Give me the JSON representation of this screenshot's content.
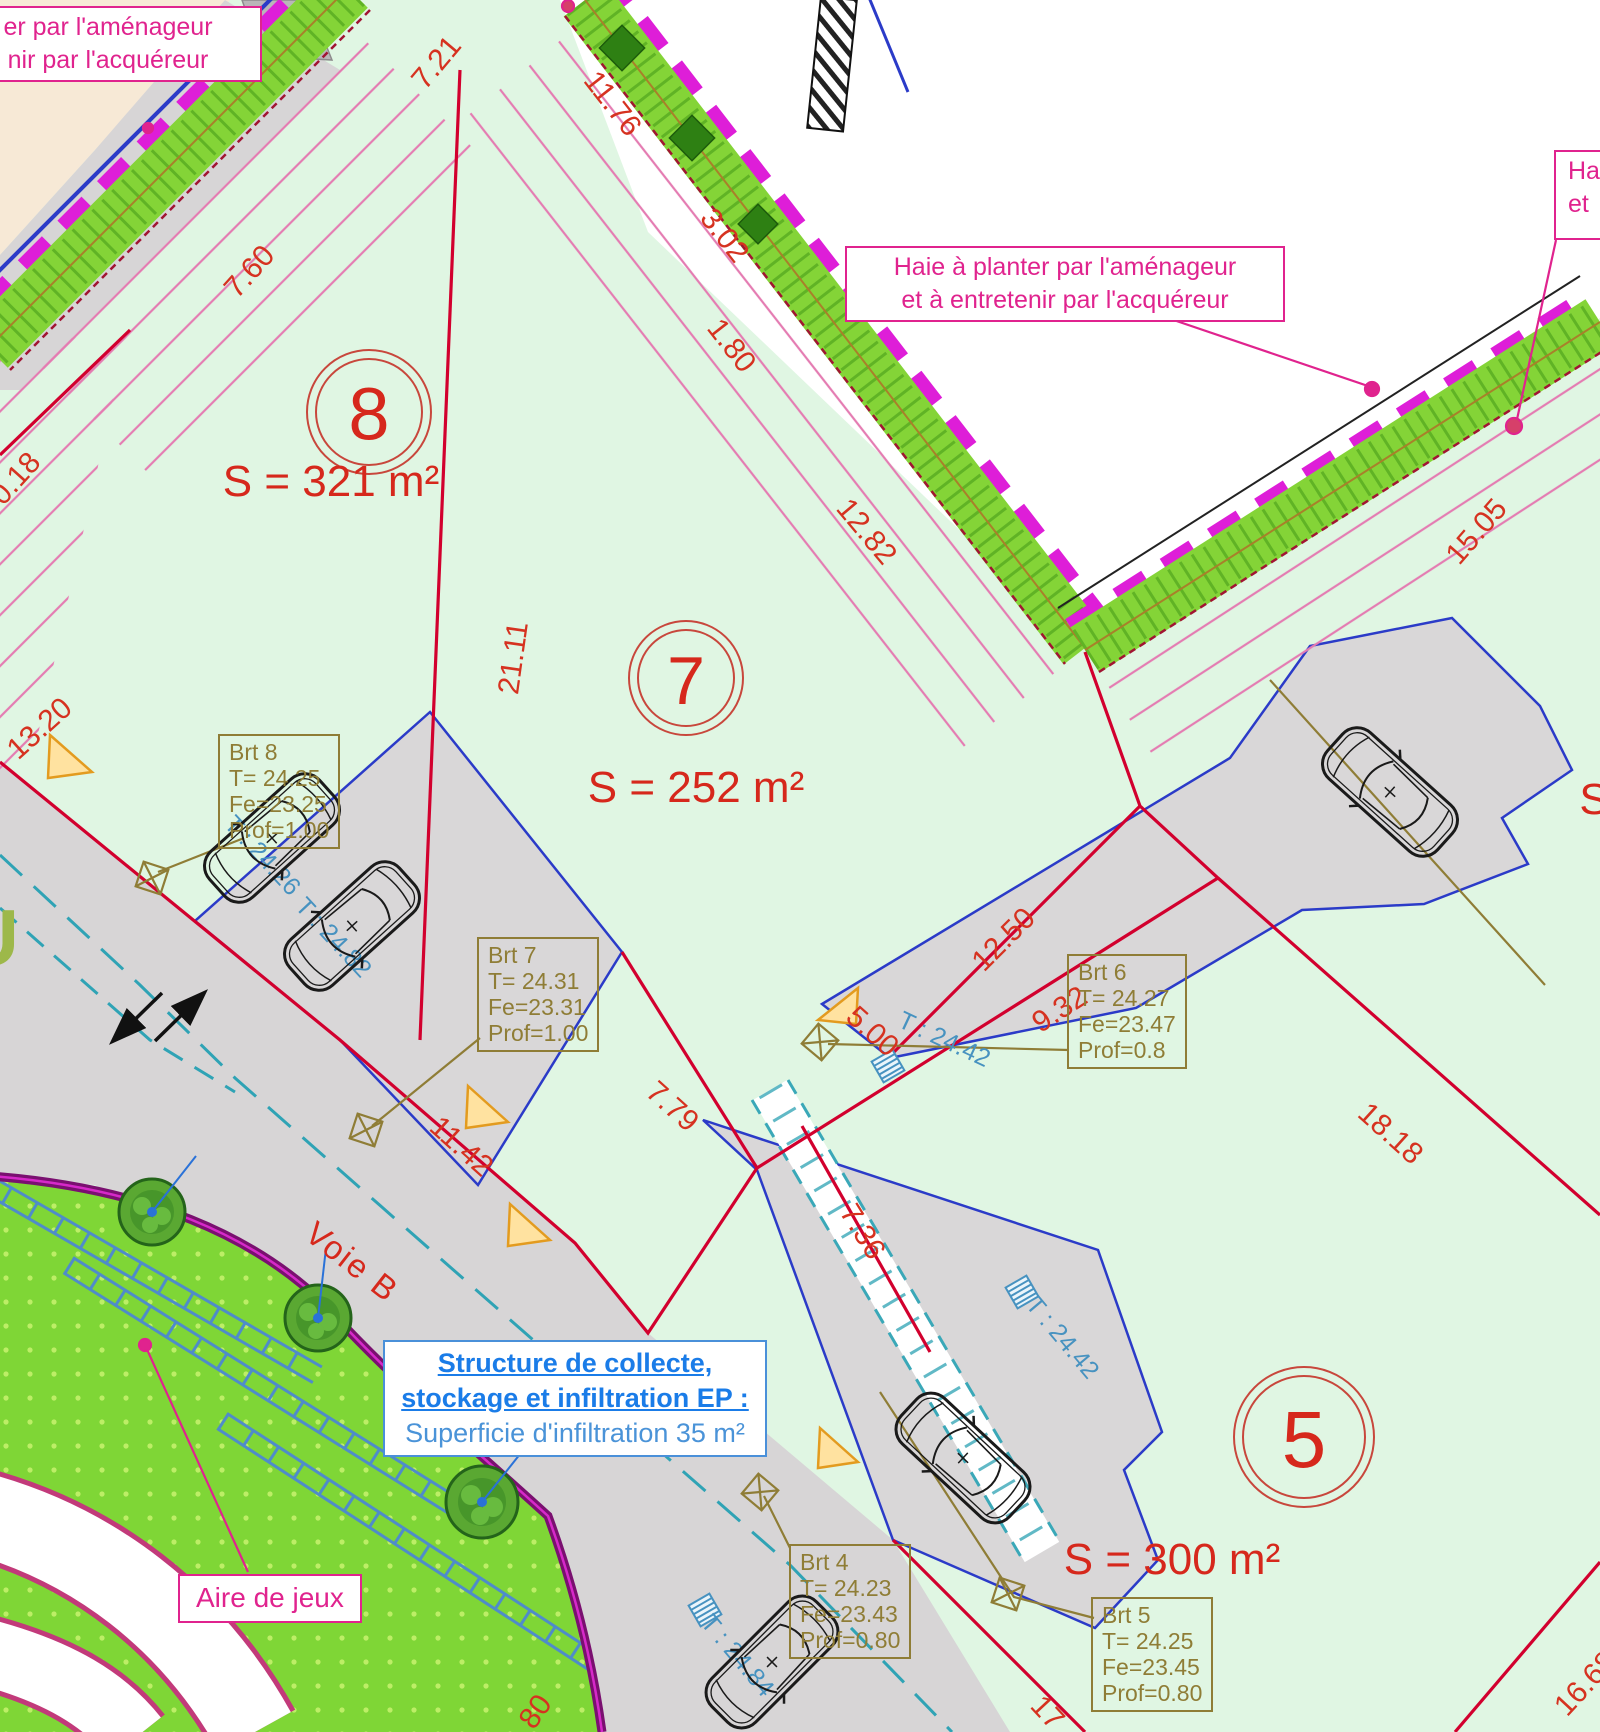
{
  "plan": {
    "notes": {
      "left_partial": {
        "l1": "er par l'aménageur",
        "l2": "nir par l'acquéreur"
      },
      "center": {
        "l1": "Haie à planter par l'aménageur",
        "l2": "et à entretenir par l'acquéreur"
      },
      "right_partial": {
        "l1": "Ha",
        "l2": "et"
      },
      "infiltration": {
        "l1": "Structure de collecte,",
        "l2": "stockage et infiltration EP :",
        "l3": "Superficie d'infiltration 35 m²"
      },
      "playground": "Aire de jeux",
      "road": "Voie B",
      "street_partial": "U",
      "lot_partial": "S"
    },
    "lots": [
      {
        "number": "8",
        "area": "S = 321 m²"
      },
      {
        "number": "7",
        "area": "S = 252 m²"
      },
      {
        "number": "5",
        "area": "S = 300 m²"
      }
    ],
    "service_boxes": [
      {
        "name": "Brt 8",
        "t": "T= 24.25",
        "fe": "Fe=23.25",
        "prof": "Prof=1.00"
      },
      {
        "name": "Brt 7",
        "t": "T= 24.31",
        "fe": "Fe=23.31",
        "prof": "Prof=1.00"
      },
      {
        "name": "Brt 6",
        "t": "T= 24.27",
        "fe": "Fe=23.47",
        "prof": "Prof=0.8"
      },
      {
        "name": "Brt 4",
        "t": "T= 24.23",
        "fe": "Fe=23.43",
        "prof": "Prof=0.80"
      },
      {
        "name": "Brt 5",
        "t": "T= 24.25",
        "fe": "Fe=23.45",
        "prof": "Prof=0.80"
      }
    ],
    "dimensions": [
      {
        "v": "7.21"
      },
      {
        "v": "11.76"
      },
      {
        "v": "3.02"
      },
      {
        "v": "1.80"
      },
      {
        "v": "7.60"
      },
      {
        "v": "0.18"
      },
      {
        "v": "13.20"
      },
      {
        "v": "21.11"
      },
      {
        "v": "12.82"
      },
      {
        "v": "15.05"
      },
      {
        "v": "12.50"
      },
      {
        "v": "11.42"
      },
      {
        "v": "7.79"
      },
      {
        "v": "5.00"
      },
      {
        "v": "9.32"
      },
      {
        "v": "18.18"
      },
      {
        "v": "7.36"
      },
      {
        "v": "17"
      },
      {
        "v": "16.68"
      },
      {
        "v": "80"
      }
    ],
    "levels": [
      {
        "v": "T : 24.26"
      },
      {
        "v": "T : 24.82"
      },
      {
        "v": "T : 24.42"
      },
      {
        "v": "T : 24.42"
      },
      {
        "v": "T : 24.84"
      }
    ],
    "colors": {
      "boundary_red": "#d2002e",
      "dimension_red": "#d63220",
      "hedge_green": "#84d437",
      "hedge_magenta": "#de1ed8",
      "note_pink": "#e0238e",
      "service_olive": "#8f7d36",
      "level_blue": "#4792c0",
      "infiltration_blue": "#1a7ce8",
      "road_gray": "#d7d5d6",
      "lot_green": "#e0f6e3",
      "playground_green": "#7fd636"
    }
  }
}
